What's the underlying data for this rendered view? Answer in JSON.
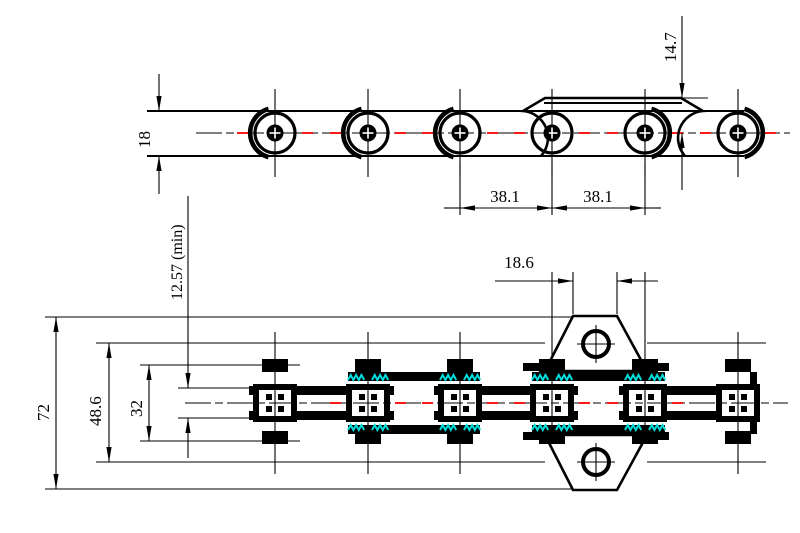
{
  "colors": {
    "ink": "#000000",
    "paper": "#ffffff",
    "centerline_red": "#ff0000",
    "hatch_cyan": "#00dcdc"
  },
  "side_view": {
    "dim_roller_od": "18",
    "dim_attachment_height": "14.7",
    "dim_pitch_left": "38.1",
    "dim_pitch_right": "38.1"
  },
  "plan_view": {
    "dim_overall_width": "72",
    "dim_pin_length": "48.6",
    "dim_over_plates": "32",
    "dim_min_inner_width": "12.57 (min)",
    "dim_attachment_top_width": "18.6"
  }
}
